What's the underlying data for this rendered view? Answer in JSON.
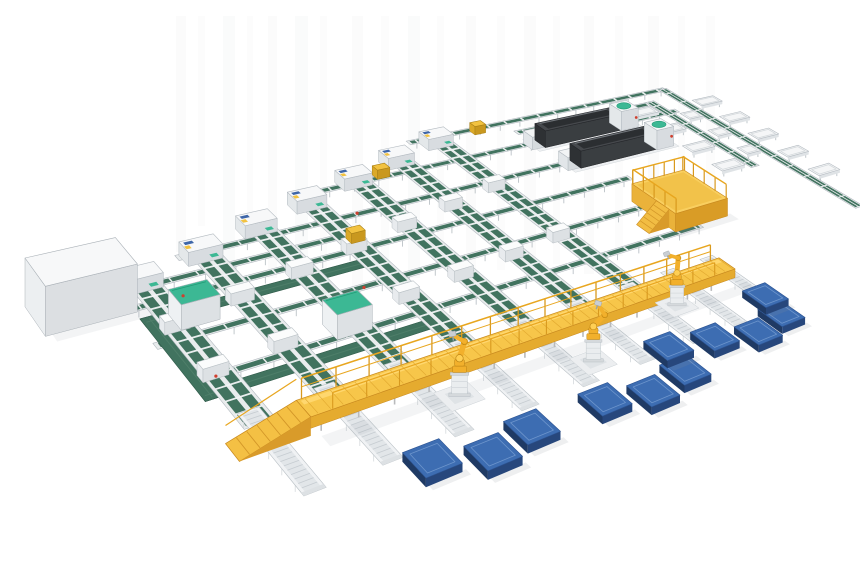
{
  "meta": {
    "aria_label": "3D isometric render of an automated panel sorting line with green belt conveyors, a yellow elevated walkway, three yellow palletizing robots and blue pallets",
    "width": 860,
    "height": 580
  },
  "inventory": {
    "sorter_columns": 7,
    "transfer_lines": 8,
    "chute_lines": 2,
    "chute_tables": 12,
    "inline_machines": 2,
    "operator_platforms": 1,
    "elevated_walkways": 1,
    "robots": 3,
    "pallets": 11,
    "loop_conveyors": 1,
    "cabinets": 3
  },
  "scene": {
    "colors": {
      "green": "#41735f",
      "green_dark": "#2f5a49",
      "green_mid": "#54836e",
      "mint": "#3cb894",
      "mint_dark": "#239b77",
      "yellow": "#f7c64a",
      "yellow_light": "#ffd76e",
      "yellow_deep": "#d99b2a",
      "yellow_edge": "#c8891f",
      "steel": "#e9eced",
      "steel_edge": "#b3bac0",
      "blue_top": "#3d6db2",
      "blue_front": "#27477c",
      "blue_side": "#1f3a64",
      "blue_line": "#6d95cc",
      "machine_top": "#46494d",
      "machine_side": "#2e3134",
      "machine_front": "#3a3e41",
      "red": "#cf3f2e",
      "robot_yellow": "#f2b02c",
      "robot_edge": "#b57f12",
      "bg": "#ffffff"
    },
    "streaks": [
      [
        176,
        10,
        236,
        0.05
      ],
      [
        198,
        7,
        210,
        0.04
      ],
      [
        223,
        12,
        250,
        0.06
      ],
      [
        247,
        6,
        228,
        0.04
      ],
      [
        268,
        9,
        262,
        0.05
      ],
      [
        295,
        13,
        240,
        0.06
      ],
      [
        320,
        7,
        255,
        0.04
      ],
      [
        352,
        11,
        270,
        0.05
      ],
      [
        381,
        8,
        246,
        0.04
      ],
      [
        408,
        12,
        262,
        0.06
      ],
      [
        437,
        7,
        250,
        0.04
      ],
      [
        466,
        10,
        268,
        0.05
      ],
      [
        497,
        8,
        254,
        0.04
      ],
      [
        524,
        12,
        266,
        0.05
      ],
      [
        553,
        7,
        248,
        0.04
      ],
      [
        584,
        10,
        258,
        0.05
      ],
      [
        615,
        8,
        240,
        0.04
      ],
      [
        648,
        11,
        228,
        0.05
      ],
      [
        678,
        7,
        205,
        0.04
      ],
      [
        706,
        9,
        180,
        0.04
      ]
    ],
    "a_lines": [
      {
        "v": -5,
        "u0": 430,
        "u1": 1005
      },
      {
        "v": 35,
        "u0": 620,
        "u1": 940
      },
      {
        "v": 78,
        "u0": 225,
        "u1": 960
      },
      {
        "v": 160,
        "u0": -30,
        "u1": 780
      },
      {
        "v": 205,
        "u0": -110,
        "u1": 215
      },
      {
        "v": 245,
        "u0": -130,
        "u1": 700
      },
      {
        "v": 330,
        "u0": -130,
        "u1": 780
      },
      {
        "v": 415,
        "u0": -120,
        "u1": 700
      }
    ],
    "loop": {
      "u0": -120,
      "v0": 260,
      "u1": 215,
      "v1": 445,
      "t": 20
    },
    "columns": [
      {
        "u": 480,
        "v0": 0
      },
      {
        "u": 385,
        "v0": 31
      },
      {
        "u": 290,
        "v0": 62
      },
      {
        "u": 195,
        "v0": 93
      },
      {
        "u": 100,
        "v0": 124
      },
      {
        "u": 5,
        "v0": 155
      },
      {
        "u": -90,
        "v0": 186
      }
    ],
    "column_v1": 520,
    "chute_lines": [
      {
        "u": 1002,
        "v0": -10,
        "v1": 490
      },
      {
        "u": 938,
        "v0": 25,
        "v1": 305
      }
    ],
    "chute_tables": [
      [
        1016,
        60,
        56
      ],
      [
        1016,
        135,
        56
      ],
      [
        1016,
        210,
        56
      ],
      [
        1016,
        285,
        56
      ],
      [
        1016,
        360,
        56
      ],
      [
        862,
        48,
        56
      ],
      [
        862,
        123,
        56
      ],
      [
        862,
        198,
        56
      ],
      [
        862,
        273,
        56
      ],
      [
        952,
        95,
        36
      ],
      [
        952,
        170,
        36
      ],
      [
        952,
        245,
        36
      ]
    ],
    "machines": [
      {
        "u0": 645,
        "v0": 55,
        "u1": 815,
        "v1": 85
      },
      {
        "u0": 655,
        "v0": 140,
        "u1": 825,
        "v1": 170
      }
    ],
    "big_box": {
      "u0": -225,
      "v0": 170,
      "u1": -115,
      "v1": 240,
      "z": 42
    },
    "cabinets": [
      {
        "u0": -85,
        "v0": 262,
        "u1": -35,
        "v1": 300
      },
      {
        "u0": 70,
        "v0": 368,
        "u1": 120,
        "v1": 406
      }
    ],
    "yellow_minis": [
      [
        200,
        198
      ],
      [
        560,
        -18
      ],
      [
        330,
        50
      ]
    ],
    "red_dots": [
      [
        -60,
        248
      ],
      [
        150,
        334
      ],
      [
        -95,
        418
      ],
      [
        240,
        160
      ]
    ],
    "spurs": [
      480,
      385,
      290,
      195,
      100,
      5,
      -90,
      560,
      640
    ],
    "spur_v": [
      490,
      645
    ],
    "walkway": {
      "u0": -45,
      "u1": 640,
      "v0": 518,
      "v1": 552,
      "z": 15
    },
    "platform": {
      "u0": 660,
      "v0": 295,
      "u1": 775,
      "v1": 400,
      "z": 20
    },
    "robots": [
      {
        "u": 140,
        "v": 575,
        "rot": -10
      },
      {
        "u": 330,
        "v": 600,
        "rot": 18
      },
      {
        "u": 520,
        "v": 555,
        "rot": -22
      }
    ],
    "pallets": [
      [
        20,
        640
      ],
      [
        85,
        665
      ],
      [
        150,
        652
      ],
      [
        260,
        655
      ],
      [
        325,
        672
      ],
      [
        392,
        660
      ],
      [
        408,
        610
      ],
      [
        480,
        625
      ],
      [
        545,
        645
      ],
      [
        608,
        630
      ],
      [
        622,
        585
      ]
    ],
    "pallet_size": 48
  }
}
